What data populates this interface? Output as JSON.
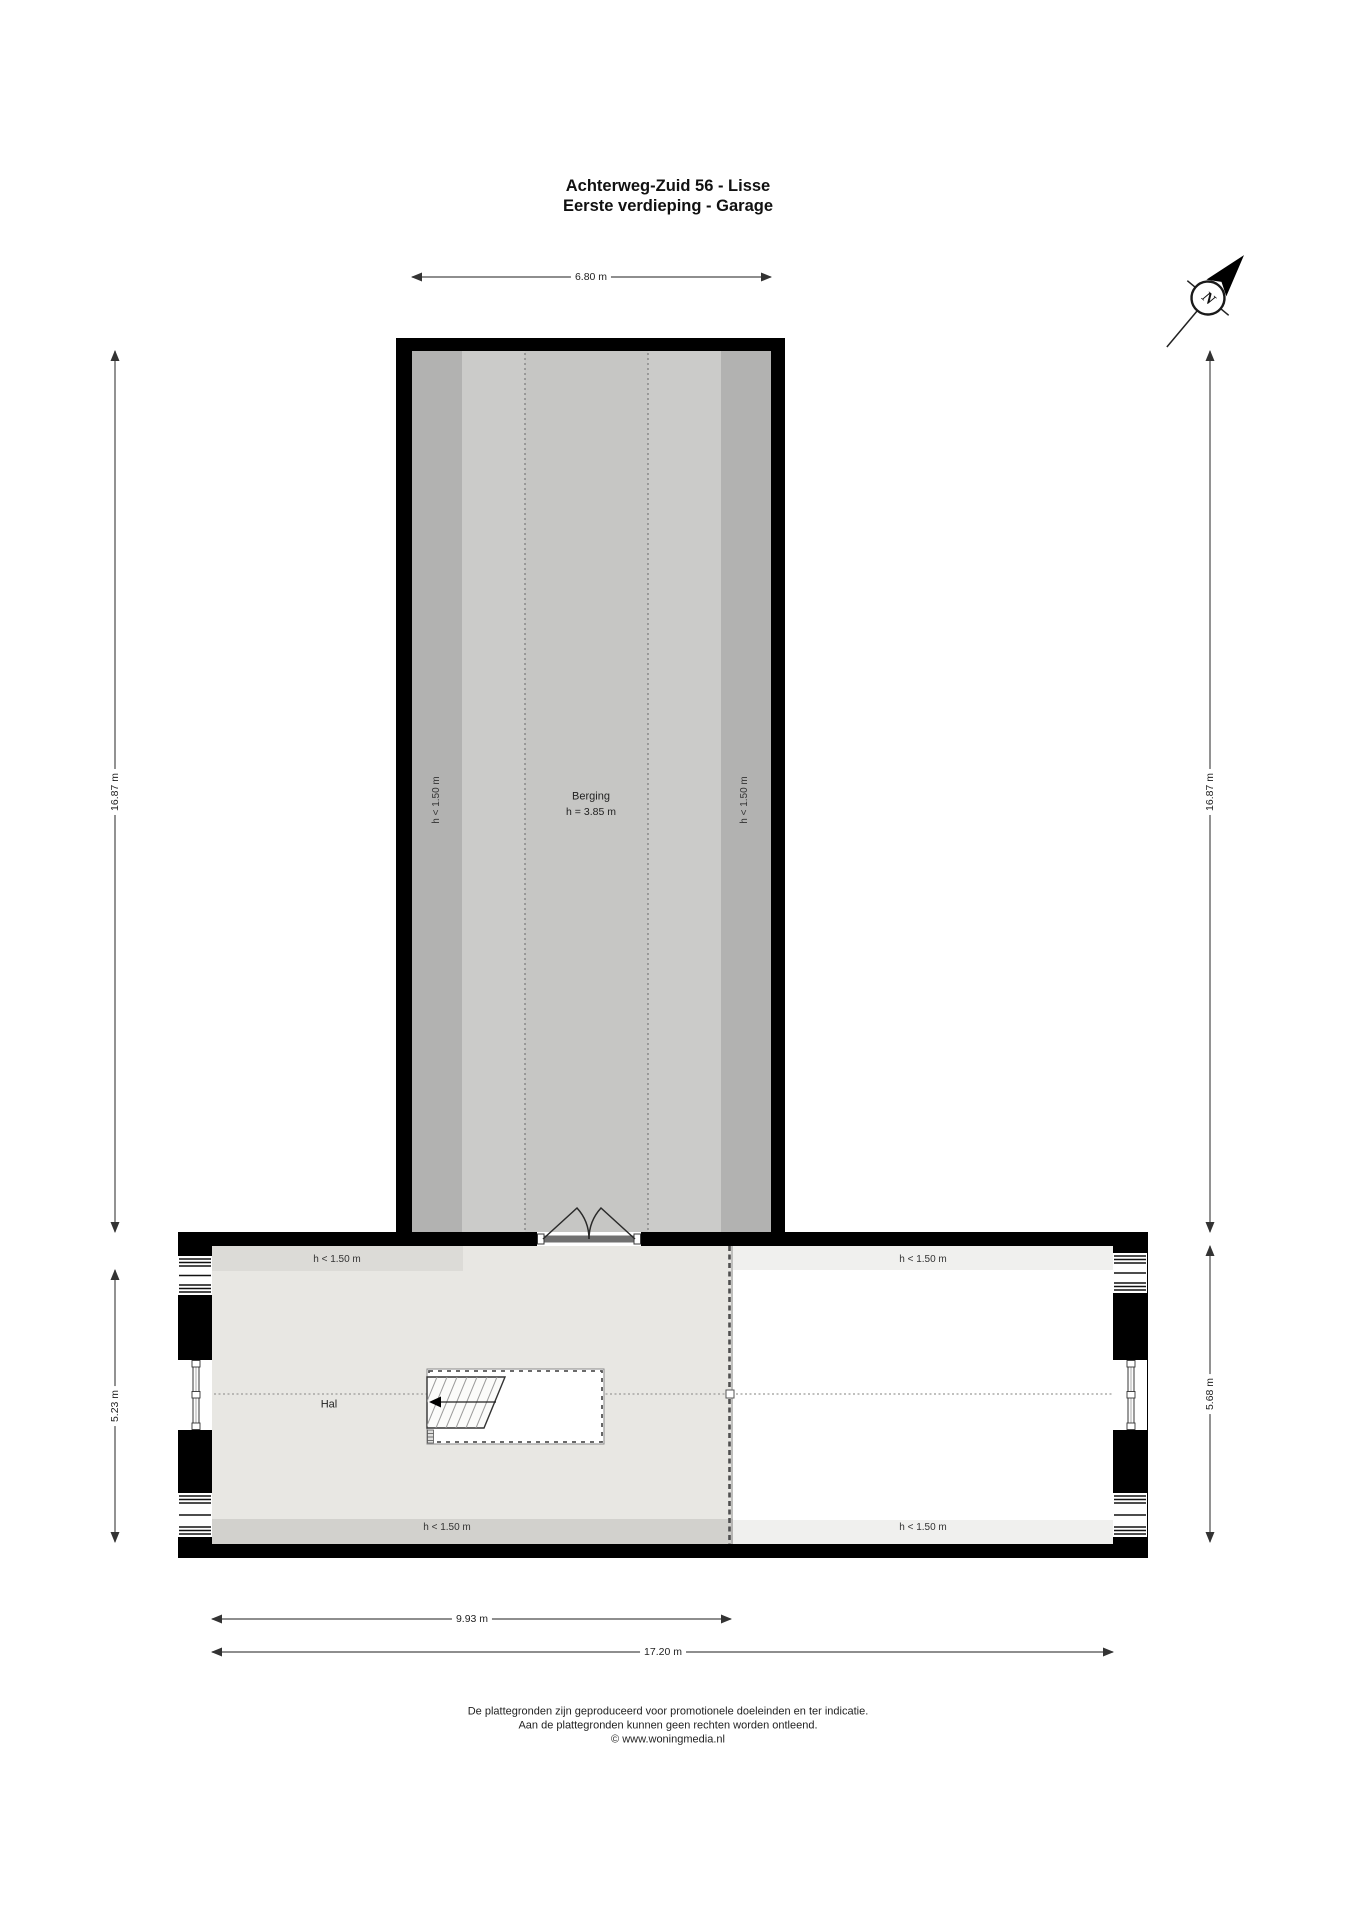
{
  "title": {
    "line1": "Achterweg-Zuid 56 - Lisse",
    "line2": "Eerste verdieping - Garage"
  },
  "compass": {
    "north_letter": "N"
  },
  "dimensions": {
    "berging_width": "6.80 m",
    "upper_left_height": "16.87 m",
    "upper_right_height": "16.87 m",
    "lower_left_height": "5.23 m",
    "lower_right_height": "5.68 m",
    "hal_width": "9.93 m",
    "total_width": "17.20 m"
  },
  "rooms": {
    "berging": {
      "name": "Berging",
      "ceiling_height": "h = 3.85 m",
      "left_low_headroom": "h < 1.50 m",
      "right_low_headroom": "h < 1.50 m"
    },
    "hal": {
      "name": "Hal",
      "top_low_headroom": "h < 1.50 m",
      "bottom_low_headroom": "h < 1.50 m"
    },
    "right_section": {
      "top_low_headroom": "h < 1.50 m",
      "bottom_low_headroom": "h < 1.50 m"
    }
  },
  "footer": {
    "line1": "De plattegronden zijn geproduceerd voor promotionele doeleinden en ter indicatie.",
    "line2": "Aan de plattegronden kunnen geen rechten worden ontleend.",
    "line3": "© www.woningmedia.nl"
  },
  "colors": {
    "wall": "#000000",
    "berging_floor": "#cbcbc9",
    "berging_low_strip": "#b2b2b1",
    "hal_floor": "#e8e7e3",
    "hal_low_strip_top": "#dcdbd7",
    "hal_low_strip_bottom": "#d2d1cd",
    "right_floor": "#ffffff",
    "right_low_strip": "#f0f0ee"
  }
}
